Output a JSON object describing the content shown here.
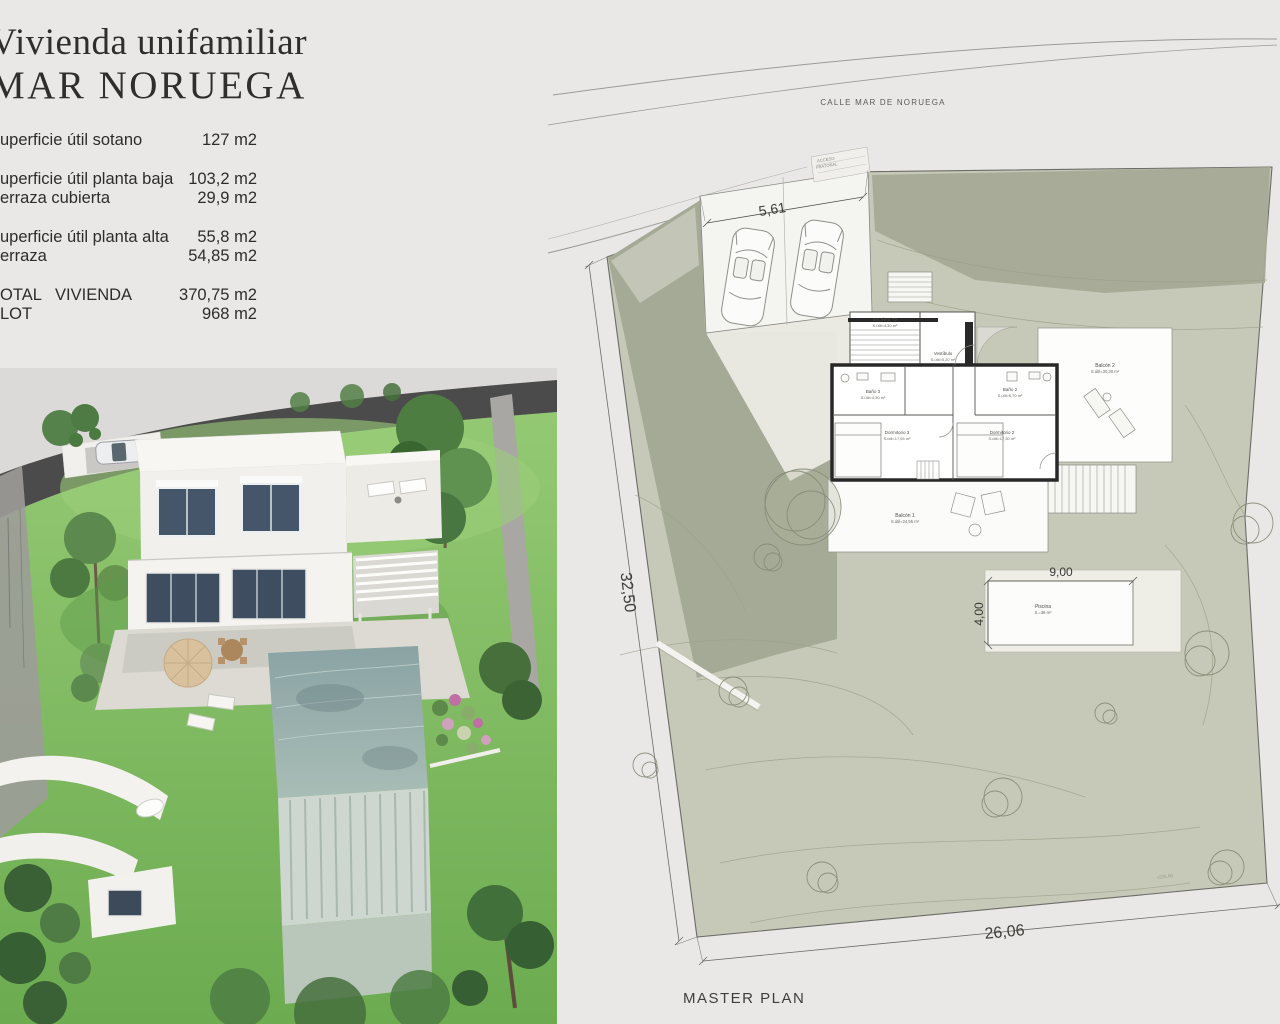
{
  "title": {
    "line1": "Vivienda unifamiliar",
    "line2": "MAR NORUEGA"
  },
  "area_table": {
    "rows": [
      {
        "label": "uperficie útil sotano",
        "value": "127 m2"
      },
      {
        "label": "uperficie útil planta baja",
        "value": "103,2 m2"
      },
      {
        "label": "erraza cubierta",
        "value": "29,9 m2"
      },
      {
        "label": "uperficie útil planta alta",
        "value": "55,8 m2"
      },
      {
        "label": "erraza",
        "value": "54,85 m2"
      },
      {
        "label": "OTAL   VIVIENDA",
        "value": "370,75 m2"
      },
      {
        "label": "LOT",
        "value": "968 m2"
      }
    ]
  },
  "site_plan": {
    "street_label": "CALLE MAR DE NORUEGA",
    "access_label_line1": "ACCESO",
    "access_label_line2": "PEATONAL",
    "caption": "MASTER PLAN",
    "level_mark": "+535,00",
    "dimensions": {
      "carport": "5,61",
      "west": "32,50",
      "south": "26,06",
      "pool_w": "9,00",
      "pool_h": "4,00"
    },
    "rooms": [
      {
        "name": "Escalera T2",
        "area": "S.útil=4,30 m²"
      },
      {
        "name": "Vestíbulo",
        "area": "S.útil=5,20 m²"
      },
      {
        "name": "Baño 3",
        "area": "S.útil=4,30 m²"
      },
      {
        "name": "Baño 2",
        "area": "S.útil=6,70 m²"
      },
      {
        "name": "Dormitorio 3",
        "area": "S.útil=17,65 m²"
      },
      {
        "name": "Dormitorio 2",
        "area": "S.útil=17,30 m²"
      },
      {
        "name": "Balcón 1",
        "area": "S.útil=24,55 m²"
      },
      {
        "name": "Balcón 2",
        "area": "S.útil=30,30 m²"
      },
      {
        "name": "Piscina",
        "area": "S.=36 m²"
      }
    ]
  },
  "colors": {
    "page_bg": "#e9e8e6",
    "garden_light": "#c6c9b7",
    "garden_dark": "#a5aa96",
    "plan_wall": "#282828",
    "lawn_green": "#7db95e",
    "pool_teal": "#8fa6a7",
    "perimeter_wall": "#4b4b4b"
  }
}
